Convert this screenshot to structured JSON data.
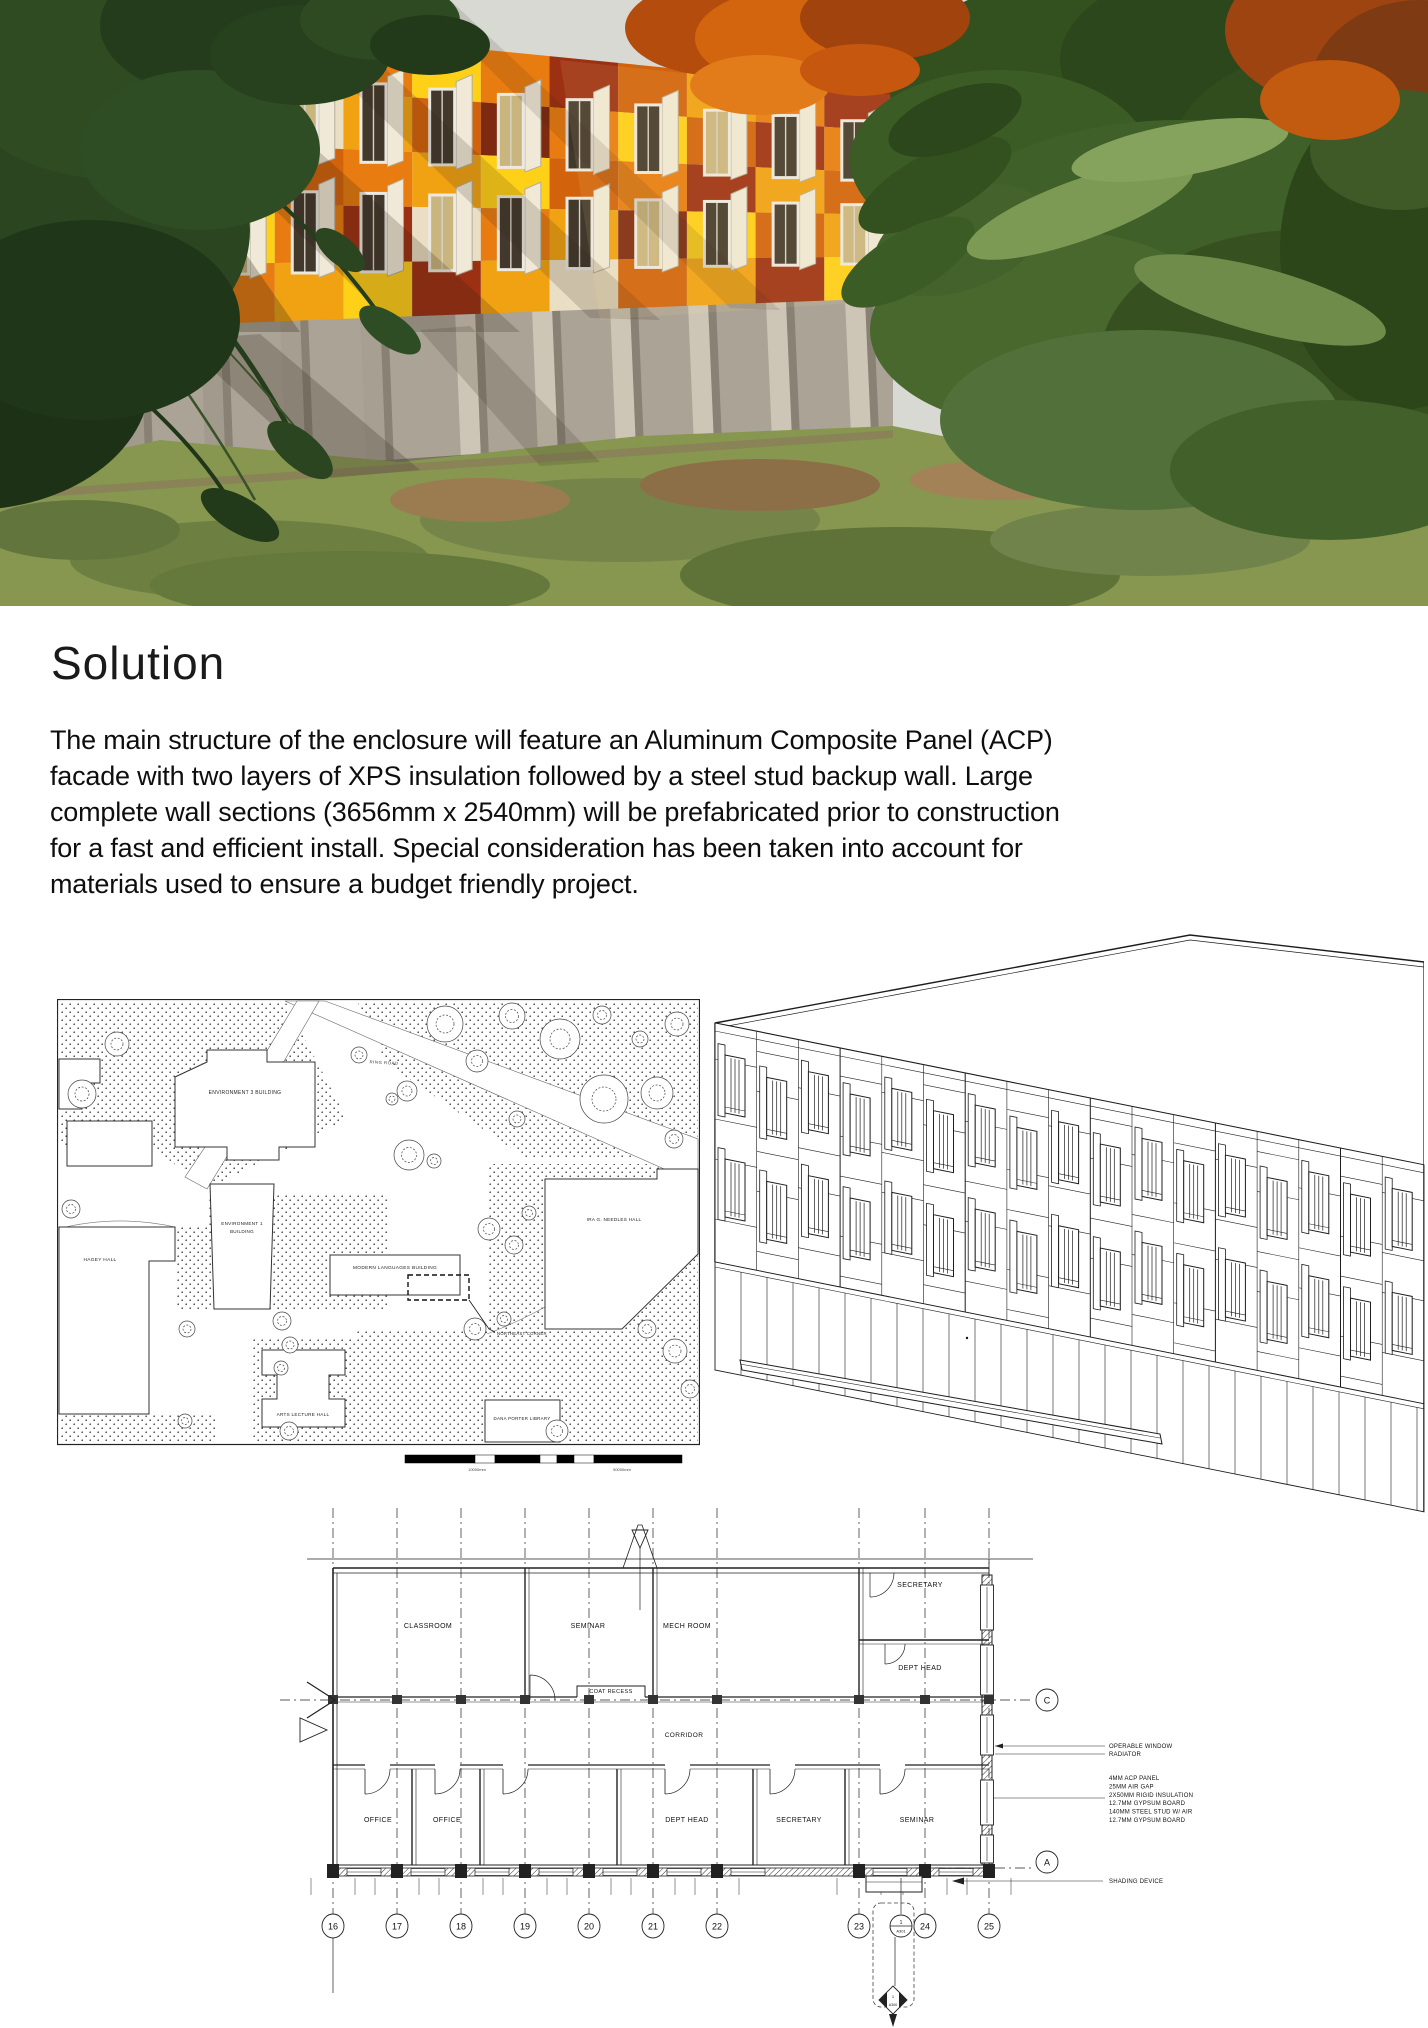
{
  "solution": {
    "heading": "Solution",
    "paragraph": " The main structure of the enclosure will feature an Aluminum Composite Panel (ACP) facade with two layers of XPS insulation followed by a steel stud backup wall. Large complete wall sections (3656mm x 2540mm) will be prefabricated prior to construction for a fast and efficient install. Special consideration has been taken into account for materials used to ensure a budget friendly project."
  },
  "render": {
    "palette": {
      "sky": "#d8d9d3",
      "concrete": "#aba396",
      "concrete_light": "#cfc8b8",
      "concrete_dark": "#7a7263",
      "grass": "#87974f",
      "pine_dark": "#22371a",
      "pine": "#3c5c26",
      "pine_light": "#7d9a55",
      "maple": "#d3650f",
      "frame": "#ece9e1",
      "glass": "#42382c",
      "glass_lit": "#c9b67f",
      "fin": "#f0e9d7",
      "panel_colors": {
        "dr": "#9c3012",
        "rr": "#7e2a10",
        "o": "#e87c10",
        "do": "#d2620b",
        "a": "#f0a212",
        "y": "#ffd018",
        "gy": "#f6b90e",
        "c": "#eadfc4",
        "t": "#cdbd99",
        "b": "#8a4413"
      },
      "panel_pattern": [
        [
          "o",
          "dr",
          "do",
          "a",
          "dr",
          "o",
          "y",
          "o",
          "dr",
          "do",
          "a",
          "o",
          "dr"
        ],
        [
          "a",
          "o",
          "dr",
          "o",
          "c",
          "a",
          "do",
          "rr",
          "o",
          "y",
          "do",
          "dr",
          "o"
        ],
        [
          "y",
          "a",
          "o",
          "rr",
          "do",
          "o",
          "a",
          "y",
          "do",
          "o",
          "dr",
          "a",
          "do"
        ],
        [
          "c",
          "dr",
          "a",
          "y",
          "o",
          "dr",
          "c",
          "o",
          "a",
          "rr",
          "y",
          "do",
          "a"
        ],
        [
          "t",
          "c",
          "dr",
          "o",
          "a",
          "y",
          "dr",
          "a",
          "c",
          "do",
          "a",
          "dr",
          "y"
        ]
      ]
    }
  },
  "site_plan": {
    "labels": {
      "ring_road": "RING ROAD",
      "env3": "ENVIRONMENT 3 BUILDING",
      "env1_line1": "ENVIRONMENT 1",
      "env1_line2": "BUILDING",
      "hagey": "HAGEY HALL",
      "modern": "MODERN LANGUAGES BUILDING",
      "northeast": "NORTHEAST CORNER",
      "arts": "ARTS LECTURE HALL",
      "dana": "DANA PORTER LIBRARY",
      "ira": "IRA G. NEEDLES HALL"
    },
    "scale_labels": [
      "10000mm",
      "50000mm"
    ]
  },
  "floor_plan": {
    "rooms": {
      "classroom": "CLASSROOM",
      "seminar_top": "SEMINAR",
      "mech": "MECH ROOM",
      "secretary_top": "SECRETARY",
      "dept_head_top": "DEPT HEAD",
      "coat": "COAT RECESS",
      "corridor": "CORRIDOR",
      "office1": "OFFICE",
      "office2": "OFFICE",
      "dept_head_bottom": "DEPT HEAD",
      "secretary_bottom": "SECRETARY",
      "seminar_bottom": "SEMINAR"
    },
    "grid_numbers": [
      "16",
      "17",
      "18",
      "19",
      "20",
      "21",
      "22",
      "23",
      "24",
      "25"
    ],
    "grid_letters": [
      "C",
      "A"
    ],
    "callouts": {
      "operable_window": "OPERABLE WINDOW",
      "radiator": "RADIATOR",
      "shading": "SHADING DEVICE"
    },
    "wall_assembly": [
      "4MM ACP PANEL",
      "25MM AIR GAP",
      "2X50MM RIGID INSULATION",
      "12.7MM GYPSUM BOARD",
      "140MM STEEL STUD W/ AIR",
      "12.7MM GYPSUM BOARD"
    ],
    "section_markers": {
      "c1": "1",
      "c2": "A301",
      "d1": "1",
      "d2": "A300"
    }
  }
}
